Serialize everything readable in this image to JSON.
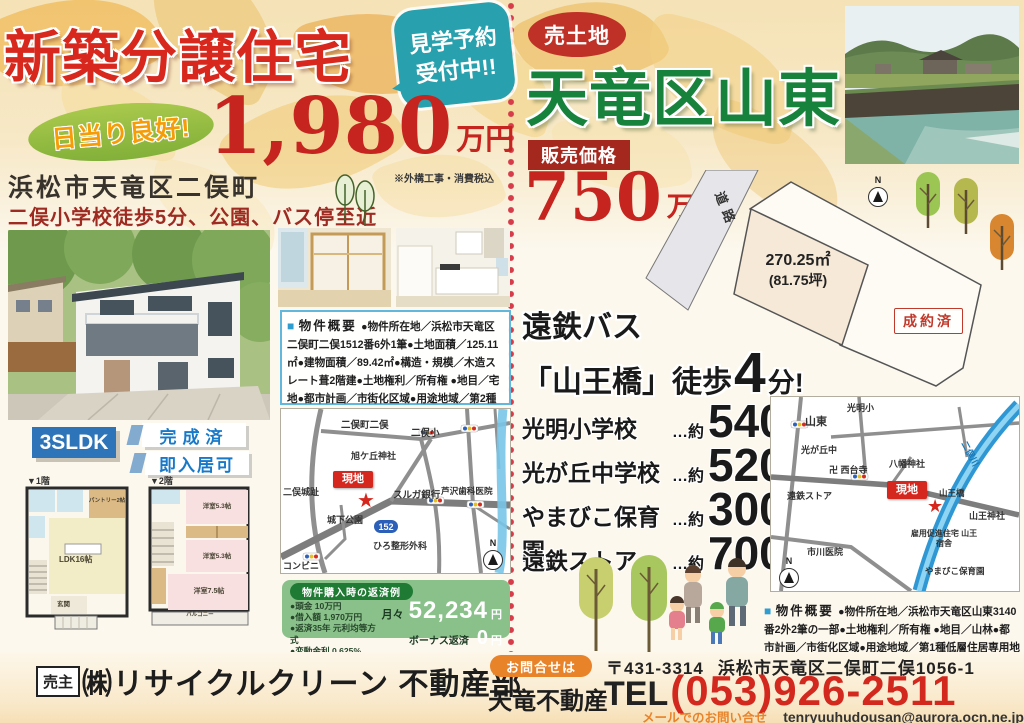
{
  "flyer": {
    "left": {
      "title": "新築分譲住宅",
      "tour_badge": {
        "line1": "見学予約",
        "line2": "受付中!!"
      },
      "sun_badge": "日当り良好!",
      "price": {
        "value": "1,980",
        "unit": "万円",
        "note": "※外構工事・消費税込"
      },
      "address": "浜松市天竜区二俣町",
      "highlights": "二俣小学校徒歩5分、公園、バス停至近",
      "plan_badge": "3SLDK",
      "status_badges": [
        "完成済",
        "即入居可"
      ],
      "overview": {
        "marker": "■",
        "heading": "物件概要",
        "body": "●物件所在地／浜松市天竜区二俣町二俣1512番6外1筆●土地面積／125.11㎡●建物面積／89.42㎡●構造・規模／木造スレート葺2階建●土地権利／所有権 ●地目／宅地●都市計画／市街化区域●用途地域／第2種住居地域●建ぺい率／70%●容積率／160% ●築年月／平成29年6月●現況／完成済"
      },
      "map": {
        "town": "二俣町二俣",
        "school": "二俣小",
        "shrine": "旭ケ丘神社",
        "site": "現地",
        "marker": "★",
        "castle": "二俣城趾",
        "bank": "スルガ銀行",
        "dental": "芦沢歯科医院",
        "park": "城下公園",
        "route": "152",
        "clinic": "ひろ整形外科",
        "store": "コンビニ",
        "compass": "N"
      },
      "loan": {
        "header": "物件購入時の返済例",
        "items": [
          "●頭金 10万円",
          "●借入額 1,970万円",
          "●返済35年 元利均等方式",
          "●変動金利 0.625%"
        ],
        "monthly_label": "月々",
        "monthly_value": "52,234",
        "monthly_unit": "円",
        "bonus_label": "ボーナス返済",
        "bonus_value": "0",
        "bonus_unit": "円"
      },
      "floors": {
        "f1_label": "▼1階",
        "f2_label": "▼2階",
        "ldk": "LDK16帖",
        "pantry": "パントリー2帖",
        "genkan": "玄関",
        "room1": "洋室5.3帖",
        "room2": "洋室5.3帖",
        "room3": "洋室7.5帖",
        "balcony": "バルコニー"
      }
    },
    "right": {
      "sale_badge": "売土地",
      "title": "天竜区山東",
      "price_label": "販売価格",
      "price": {
        "value": "750",
        "unit": "万円"
      },
      "plot": {
        "road": "道路",
        "area_m2": "270.25㎡",
        "area_tsubo": "(81.75坪)",
        "sold": "成約済",
        "compass": "N"
      },
      "bus": {
        "line1": "遠鉄バス",
        "line2": "「山王橋」徒歩",
        "minutes": "4",
        "unit": "分!"
      },
      "distances": [
        {
          "name": "光明小学校",
          "approx": "…約",
          "value": "540",
          "unit": "m"
        },
        {
          "name": "光が丘中学校",
          "approx": "…約",
          "value": "520",
          "unit": "m"
        },
        {
          "name": "やまびこ保育園",
          "approx": "…約",
          "value": "300",
          "unit": "m"
        },
        {
          "name": "遠鉄ストア",
          "approx": "…約",
          "value": "700",
          "unit": "m"
        }
      ],
      "map": {
        "area": "山東",
        "elementary": "光明小",
        "junior": "光が丘中",
        "store": "遠鉄ストア",
        "temple": "卍 西台寺",
        "shrine": "八幡神社",
        "river": "二俣川",
        "bridge": "山王橋",
        "site": "現地",
        "marker": "★",
        "shrine2": "山王神社",
        "housing": "雇用促進住宅 山王宿舎",
        "nursery": "やまびこ保育園",
        "hospital": "市川医院",
        "compass": "N"
      },
      "overview": {
        "marker": "■",
        "heading": "物件概要",
        "body": "●物件所在地／浜松市天竜区山東3140番2外2筆の一部●土地権利／所有権 ●地目／山林●都市計画／市街化区域●用途地域／第1種低層住居専用地域●建ぺい率／50%●容積率／80%"
      }
    },
    "footer": {
      "seller_label": "売主",
      "seller_name": "㈱リサイクルクリーン 不動産部",
      "contact_badge": "お問合せは",
      "agency": "天竜不動産",
      "postal": "〒431-3314",
      "address": "浜松市天竜区二俣町二俣1056-1",
      "tel_label": "TEL",
      "tel_number": "(053)926-2511",
      "mail_label": "メールでのお問い合せは",
      "mail_address": "tenryuuhudousan@aurora.ocn.ne.jp"
    }
  }
}
